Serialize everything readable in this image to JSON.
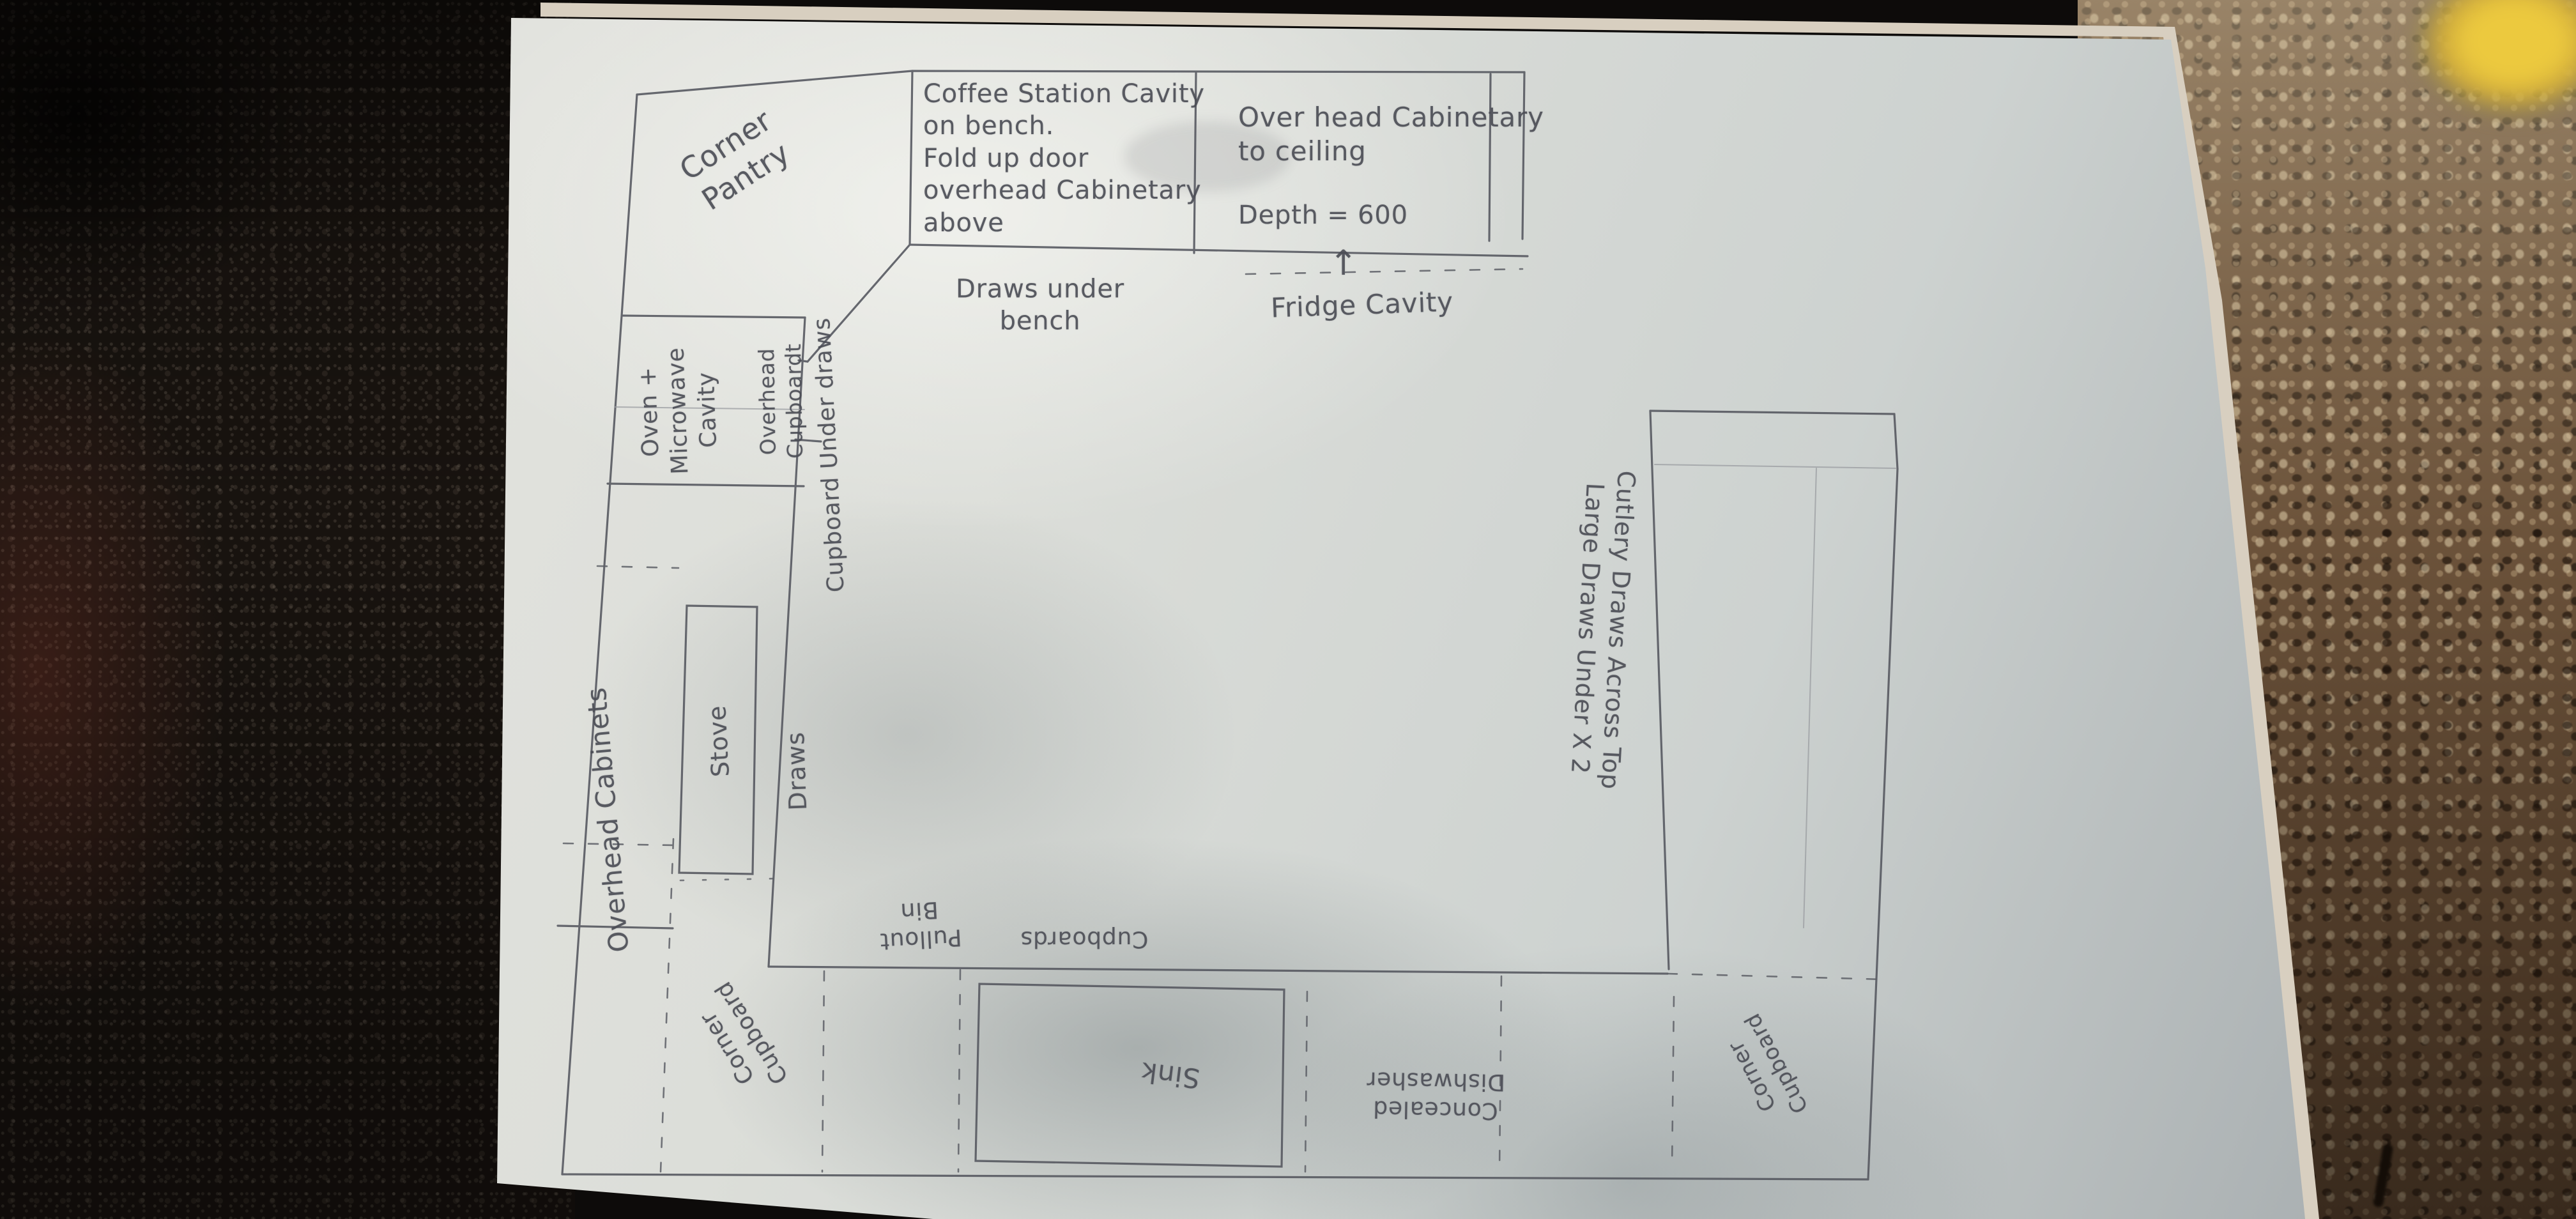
{
  "labels": {
    "corner_pantry": "Corner\nPantry",
    "coffee_station": "Coffee Station Cavity\non bench.\nFold up door\noverhead Cabinetary\n above",
    "draws_under_bench": "Draws under\nbench",
    "overhead_cabinetary": "Over head Cabinetary\nto ceiling",
    "depth": "Depth = 600",
    "fridge_arrow": "↑",
    "fridge_cavity": "Fridge Cavity",
    "oven_microwave": "Oven +\nMicrowave\nCavity",
    "overhead_cupboard": "Overhead\nCupboardt",
    "cupboard_under_draws": "Cupboard    Under draws",
    "overhead_cabinets": "Overhead Cabinets",
    "stove": "Stove",
    "draws": "Draws",
    "corner_cupboard_left": "Corner\nCupboard",
    "pullout_bin": "Pullout\nBin",
    "cupboards": "Cupboards",
    "sink": "Sink",
    "dishwasher": "Concealed\nDishwasher",
    "corner_cupboard_right": "Corner\nCupboard",
    "cutlery_draws": "Cutlery Draws Across Top\nLarge Draws Under  X 2"
  },
  "colors": {
    "paper": "#dcded9",
    "pencil": "#57595f",
    "granite_left": "#18130f",
    "granite_right": "#6b523a",
    "yellow_object": "#ecc93e"
  }
}
